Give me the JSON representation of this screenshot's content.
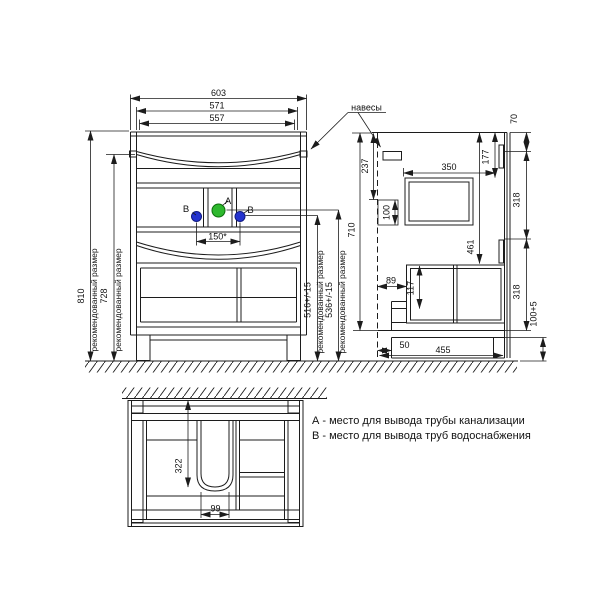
{
  "colors": {
    "background": "#ffffff",
    "line": "#1c1c1c",
    "text": "#111111",
    "circle_a_fill": "#2eb82e",
    "circle_a_stroke": "#0c6e0c",
    "circle_b_fill": "#2433cf",
    "circle_b_stroke": "#101a80"
  },
  "front_view": {
    "width_dims": {
      "outer": "603",
      "mid": "571",
      "inner": "557"
    },
    "height_dims": {
      "total": "810",
      "hanger": "728"
    },
    "recommended_label": "рекомендованный размер",
    "right_dims": {
      "water": "516+/-15",
      "drain": "536+/-15",
      "body": "710"
    },
    "spacing_dim": "150*",
    "point_a_label": "А",
    "point_b_label": "В"
  },
  "side_view": {
    "hangers_label": "навесы",
    "dims": {
      "top_offset": "237",
      "outlet_height": "100",
      "rail_top": "70",
      "front_drop": "177",
      "depth_inner": "350",
      "upper_span": "318",
      "drawer_drop": "461",
      "front_overhang": "89",
      "rail_height": "117",
      "lower_span": "318",
      "plinth_height": "100+5",
      "plinth_recess": "50",
      "base_depth": "455"
    }
  },
  "plan_view": {
    "dims": {
      "cutout_depth": "322",
      "cutout_width": "99"
    }
  },
  "legend": {
    "line_a": "А - место для вывода трубы канализации",
    "line_b": "В - место для вывода труб водоснабжения"
  }
}
